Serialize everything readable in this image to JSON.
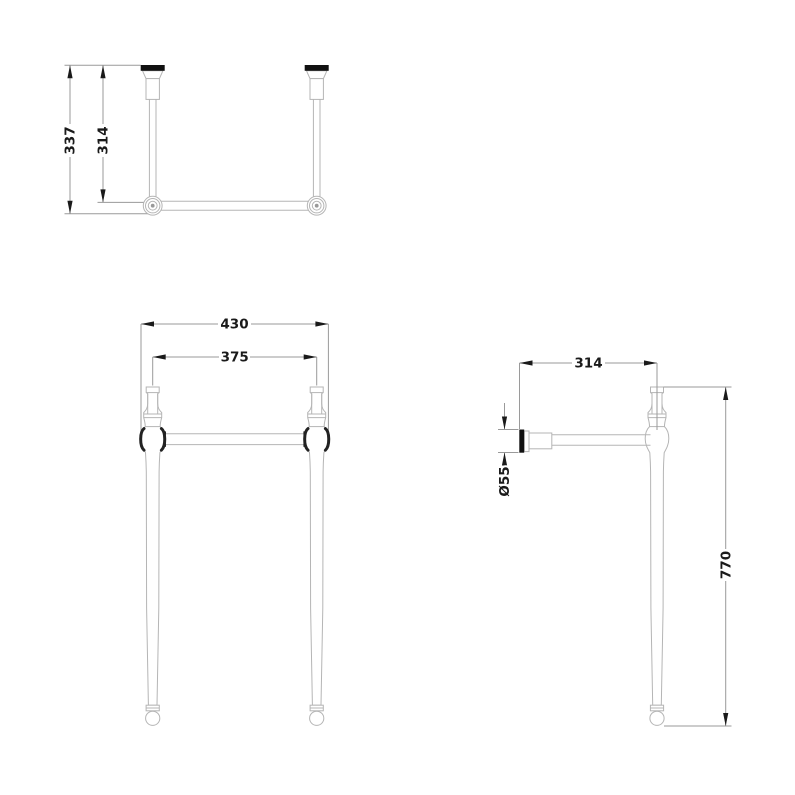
{
  "drawing": {
    "plan_view": {
      "dim_depth_overall": "337",
      "dim_depth_to_leg_axis": "314"
    },
    "front_view": {
      "dim_width_overall": "430",
      "dim_width_between_legs": "375"
    },
    "side_view": {
      "dim_depth": "314",
      "dim_flange_diameter": "Ø55",
      "dim_height": "770"
    },
    "colors": {
      "background": "#ffffff",
      "outline": "#b5b5b5",
      "dimension_line": "#9a9a9a",
      "text_and_arrows": "#1a1a1a",
      "solid_fittings": "#111111"
    }
  }
}
